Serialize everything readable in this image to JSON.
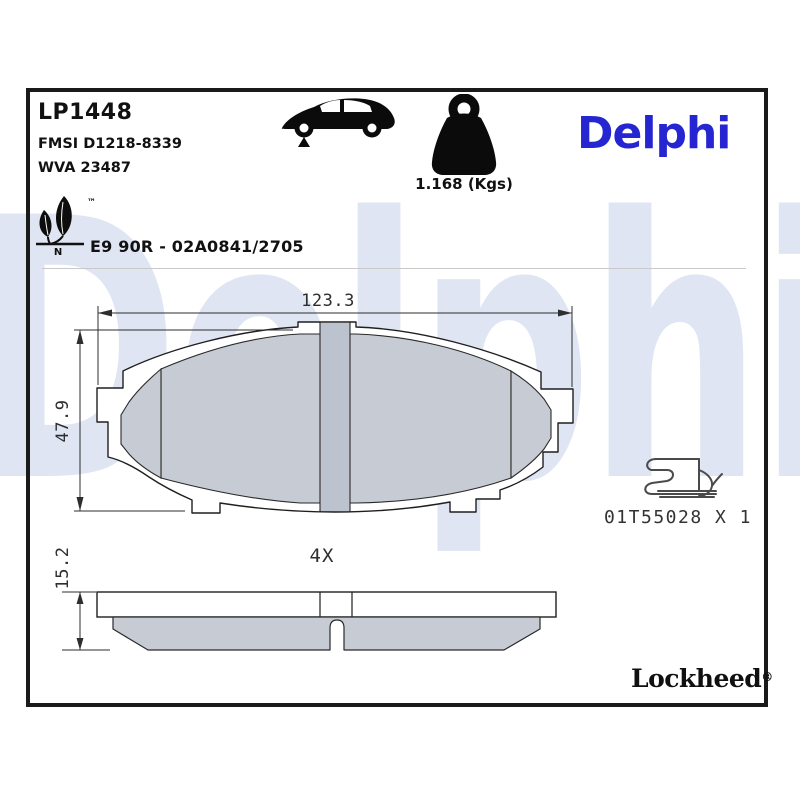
{
  "watermark": {
    "text": "Delphi"
  },
  "header": {
    "part_number": "LP1448",
    "fmsi": "FMSI D1218-8339",
    "wva": "WVA 23487",
    "weight": "1.168 (Kgs)",
    "brand": "Delphi",
    "trademark": "™",
    "eco_note": "N",
    "homologation": "E9 90R - 02A0841/2705"
  },
  "icons": {
    "vehicle": "car-front-axle-icon",
    "mass": "weight-icon",
    "eco": "eco-leaf-icon"
  },
  "front_view": {
    "width_mm": "123.3",
    "height_mm": "47.9"
  },
  "side_view": {
    "thickness_mm": "15.2",
    "quantity": "4X"
  },
  "accessory": {
    "code": "01T55028 X 1"
  },
  "footer": {
    "brand": "Lockheed",
    "registered": "®"
  },
  "colors": {
    "delphi_blue": "#2526d2",
    "watermark_blue": "#dfe5f2",
    "friction_gray": "#c6cbd4",
    "slot_gray": "#bdc3ce",
    "line_black": "#1f1f1f"
  }
}
